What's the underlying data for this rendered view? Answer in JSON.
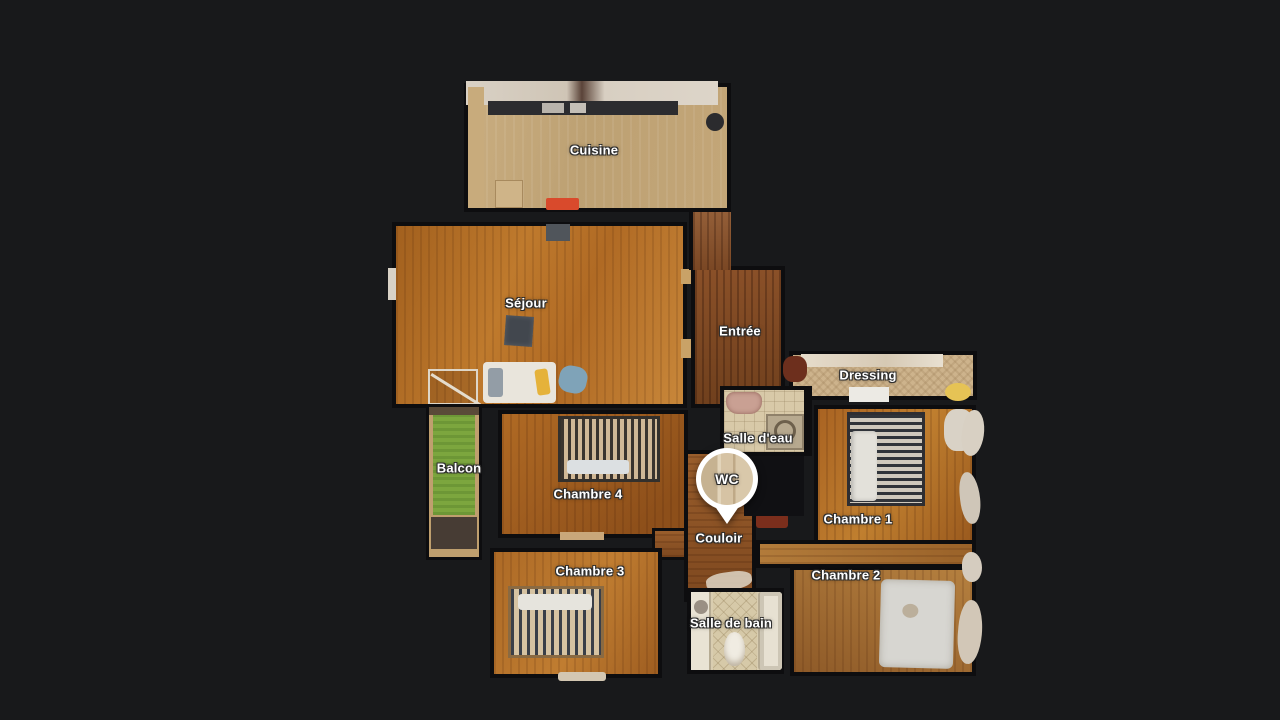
{
  "view": {
    "type": "floorplan-top-view",
    "background_color": "#18191b",
    "wall_color": "#0d0d0f",
    "label_color": "#ffffff"
  },
  "pin": {
    "label": "WC"
  },
  "rooms": [
    {
      "id": "cuisine",
      "label": "Cuisine"
    },
    {
      "id": "sejour",
      "label": "Séjour"
    },
    {
      "id": "entree",
      "label": "Entrée"
    },
    {
      "id": "dressing",
      "label": "Dressing"
    },
    {
      "id": "salle-deau",
      "label": "Salle d'eau"
    },
    {
      "id": "chambre-1",
      "label": "Chambre 1"
    },
    {
      "id": "chambre-4",
      "label": "Chambre 4"
    },
    {
      "id": "balcon",
      "label": "Balcon"
    },
    {
      "id": "couloir",
      "label": "Couloir"
    },
    {
      "id": "chambre-3",
      "label": "Chambre 3"
    },
    {
      "id": "chambre-2",
      "label": "Chambre 2"
    },
    {
      "id": "salle-de-bain",
      "label": "Salle de bain"
    }
  ],
  "palette": {
    "wood_light": "#c3a87c",
    "wood_orange": "#b5732c",
    "wood_dark": "#7e4a26",
    "tile_beige": "#d8c9a8",
    "balcony_green": "#7ca63e",
    "stove_red": "#d94a2c",
    "accent_yellow": "#e6c355",
    "furniture_white": "#e9e5dc"
  }
}
